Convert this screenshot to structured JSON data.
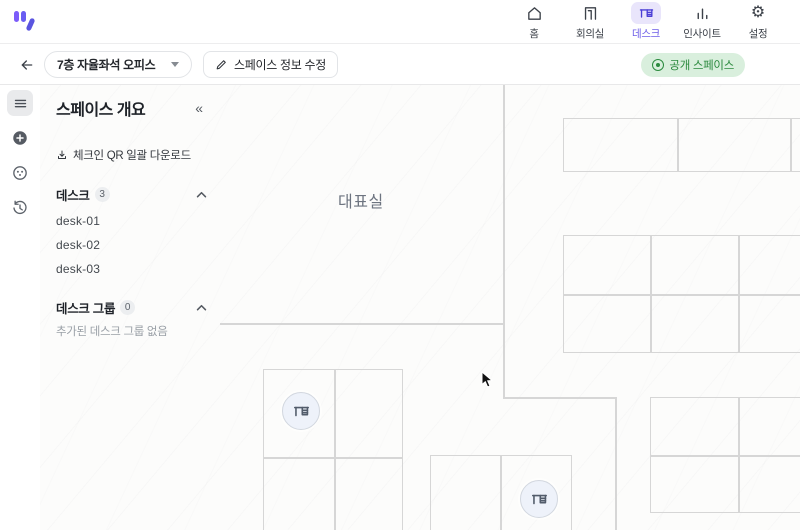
{
  "header": {
    "nav": [
      {
        "id": "home",
        "label": "홈"
      },
      {
        "id": "meeting",
        "label": "회의실"
      },
      {
        "id": "desk",
        "label": "데스크",
        "active": true
      },
      {
        "id": "insight",
        "label": "인사이트"
      },
      {
        "id": "settings",
        "label": "설정"
      }
    ]
  },
  "toolbar": {
    "space_selector_value": "7층 자율좌석 오피스",
    "edit_button_label": "스페이스 정보 수정",
    "visibility_badge_label": "공개 스페이스"
  },
  "panel": {
    "title": "스페이스 개요",
    "collapse_icon": "«",
    "qr_download_label": "체크인 QR 일괄 다운로드",
    "desk_section": {
      "label": "데스크",
      "count": "3",
      "items": [
        "desk-01",
        "desk-02",
        "desk-03"
      ]
    },
    "group_section": {
      "label": "데스크 그룹",
      "count": "0",
      "empty_text": "추가된 데스크 그룹 없음"
    }
  },
  "floorplan": {
    "room_label": "대표실"
  },
  "icons": {
    "gear_glyph": "⚙"
  },
  "colors": {
    "accent_purple": "#6c5ce7",
    "accent_purple_bg": "#e9e5fb",
    "badge_green_bg": "#d9efdd",
    "badge_green_text": "#2b8a3e",
    "wall_gray": "#d6d6d6",
    "desk_pin_fill": "#eef2fa",
    "desk_pin_glyph": "#525c6b"
  }
}
